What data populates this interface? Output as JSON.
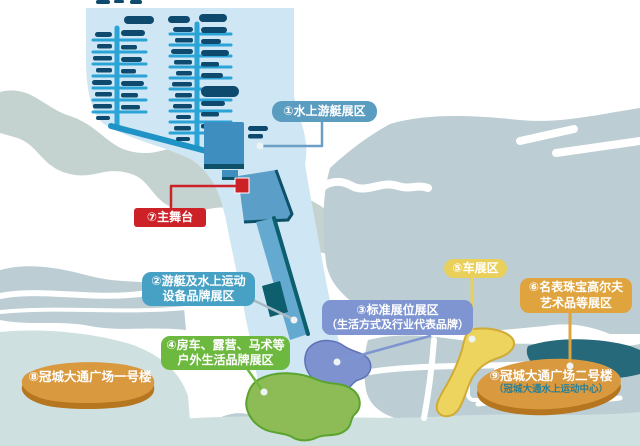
{
  "palette": {
    "marina_water": "#cfe6f4",
    "land_gray": "#bccdd3",
    "river_gray": "#c5d3d0",
    "aqua_water": "#cfe0e1",
    "dark_water": "#26697a",
    "dock_blue": "#2aa3d6",
    "boat_navy": "#0e4a6e",
    "pier_blue": "#64a9d0",
    "pier_edge": "#0d5f6e",
    "marina_building": "#3e8fc0",
    "stage_red": "#cc2127",
    "zone1_label": "#5b9cc1",
    "zone2_label": "#47a1c4",
    "zone3_label": "#7e95d2",
    "zone3_area": "#7e92cf",
    "zone4_label": "#6db93f",
    "zone4_area": "#8dbc57",
    "zone5_label": "#e9d05b",
    "zone5_area": "#edd45f",
    "zone6_label": "#e0a43e",
    "building_orange": "#d9993f",
    "building_orange_dark": "#b5761f",
    "zone9_subtitle": "#2a7f96"
  },
  "labels": {
    "zone1": {
      "text": "①水上游艇展区"
    },
    "zone2": {
      "line1": "②游艇及水上运动",
      "line2": "设备品牌展区"
    },
    "zone3": {
      "line1": "③标准展位展区",
      "line2": "（生活方式及行业代表品牌）"
    },
    "zone4": {
      "line1": "④房车、露营、马术等",
      "line2": "户外生活品牌展区"
    },
    "zone5": {
      "text": "⑤车展区"
    },
    "zone6": {
      "line1": "⑥名表珠宝高尔夫",
      "line2": "艺术品等展区"
    },
    "zone7": {
      "text": "⑦主舞台"
    },
    "zone8": {
      "text": "⑧冠城大通广场一号楼"
    },
    "zone9": {
      "line1": "⑨冠城大通广场二号楼",
      "line2": "（冠城大通水上运动中心）"
    }
  }
}
